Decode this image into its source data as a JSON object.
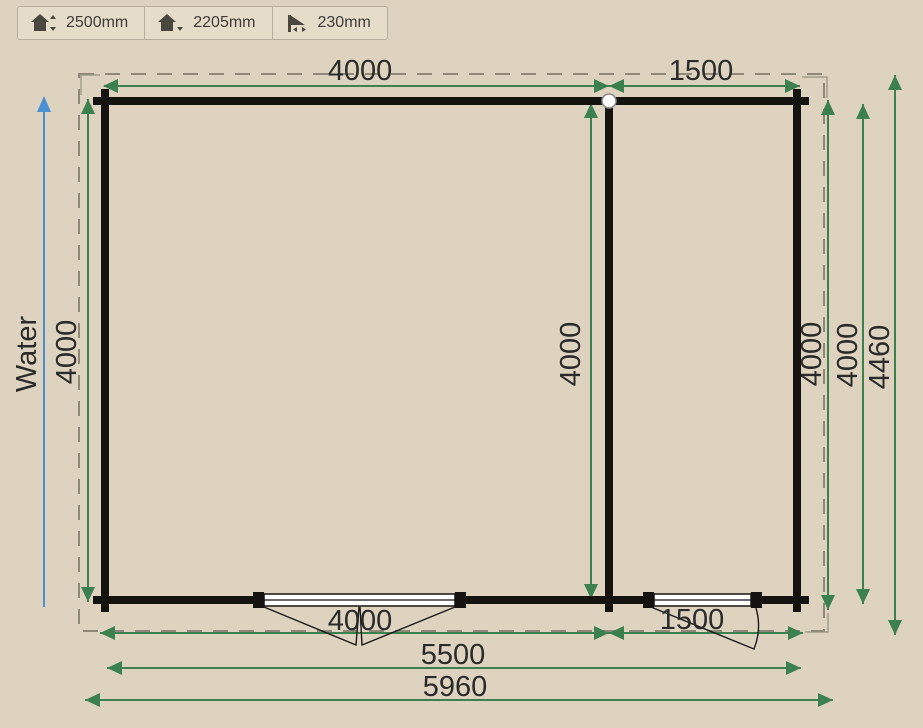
{
  "toolbar": {
    "buttons": [
      {
        "id": "ridge-height",
        "label": "2500mm"
      },
      {
        "id": "eave-height",
        "label": "2205mm"
      },
      {
        "id": "roof-overhang",
        "label": "230mm"
      }
    ]
  },
  "plan": {
    "water_label": "Water",
    "dims": {
      "top_left_room": "4000",
      "top_right_room": "1500",
      "left_depth": "4000",
      "middle_depth": "4000",
      "right_room_depth": "4000",
      "overall_depth": "4000",
      "roof_depth": "4460",
      "bottom_left_room": "4000",
      "bottom_right_room": "1500",
      "wall_width": "5500",
      "roof_width": "5960"
    }
  },
  "colors": {
    "background": "#ddd3bf",
    "dimension_green": "#3c8050",
    "water_blue": "#4a90d2",
    "wall_black": "#151310",
    "roof_dash_gray": "#8f8878"
  }
}
